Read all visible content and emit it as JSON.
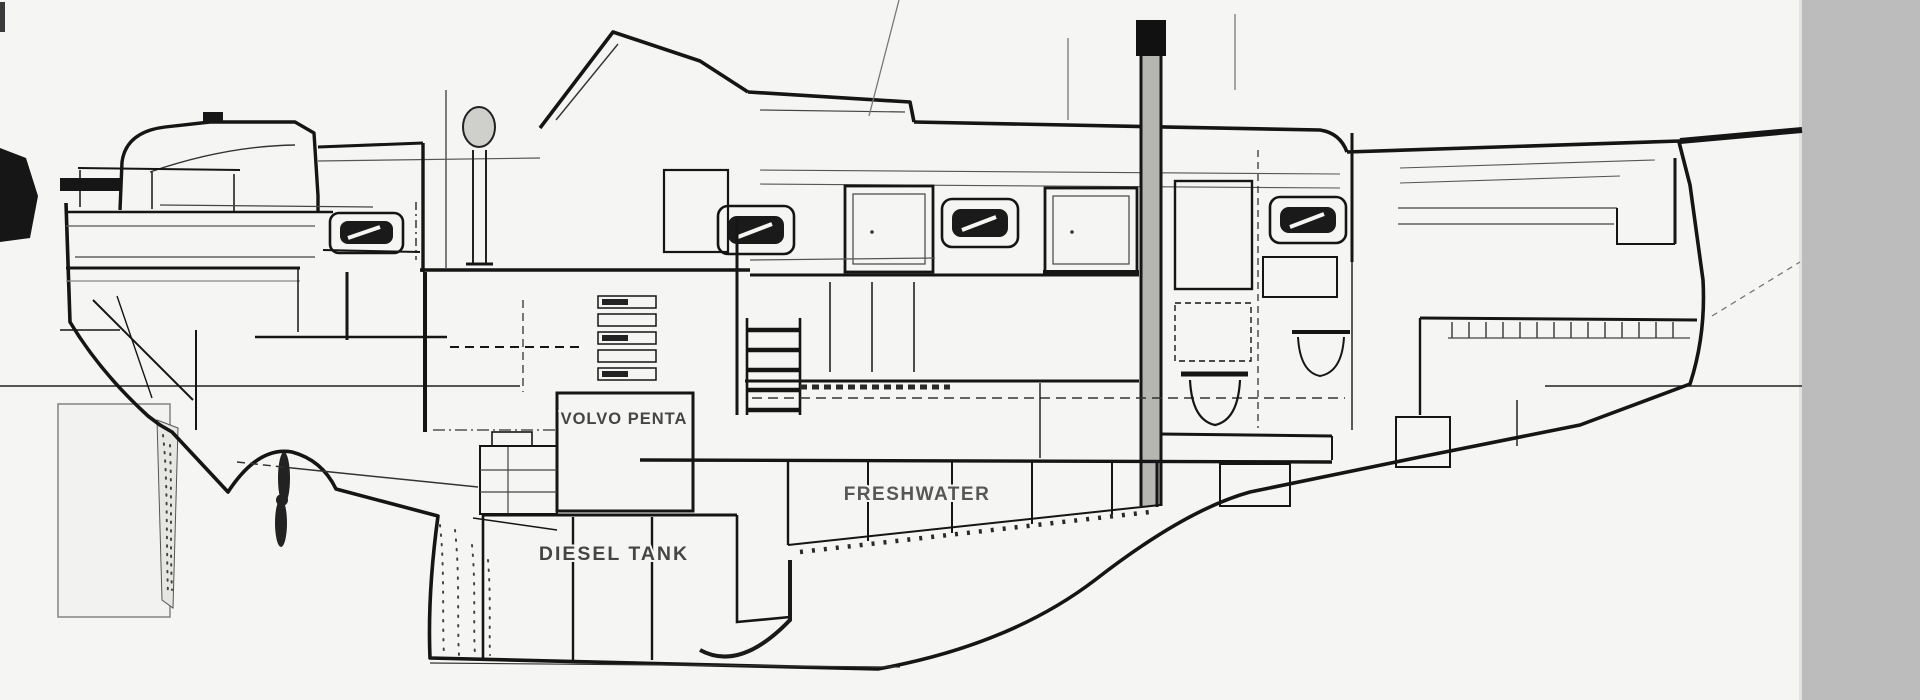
{
  "document": {
    "type": "technical-drawing",
    "subject": "sailboat interior arrangement profile (cutaway side view)"
  },
  "labels": {
    "engine": "VOLVO PENTA",
    "diesel_tank": "DIESEL TANK",
    "fresh_water": "FRESHWATER"
  },
  "colors": {
    "paper": "#f5f5f3",
    "ink": "#161616",
    "ink_gray": "#6a6a6a",
    "scan_bar": "#bcbcbc",
    "rudder_outline": "#8a8a8a",
    "mast_fill": "#b5b5b2",
    "binnacle_fill": "#cfcfcc",
    "portlight_glass": "#1a1a1a"
  }
}
